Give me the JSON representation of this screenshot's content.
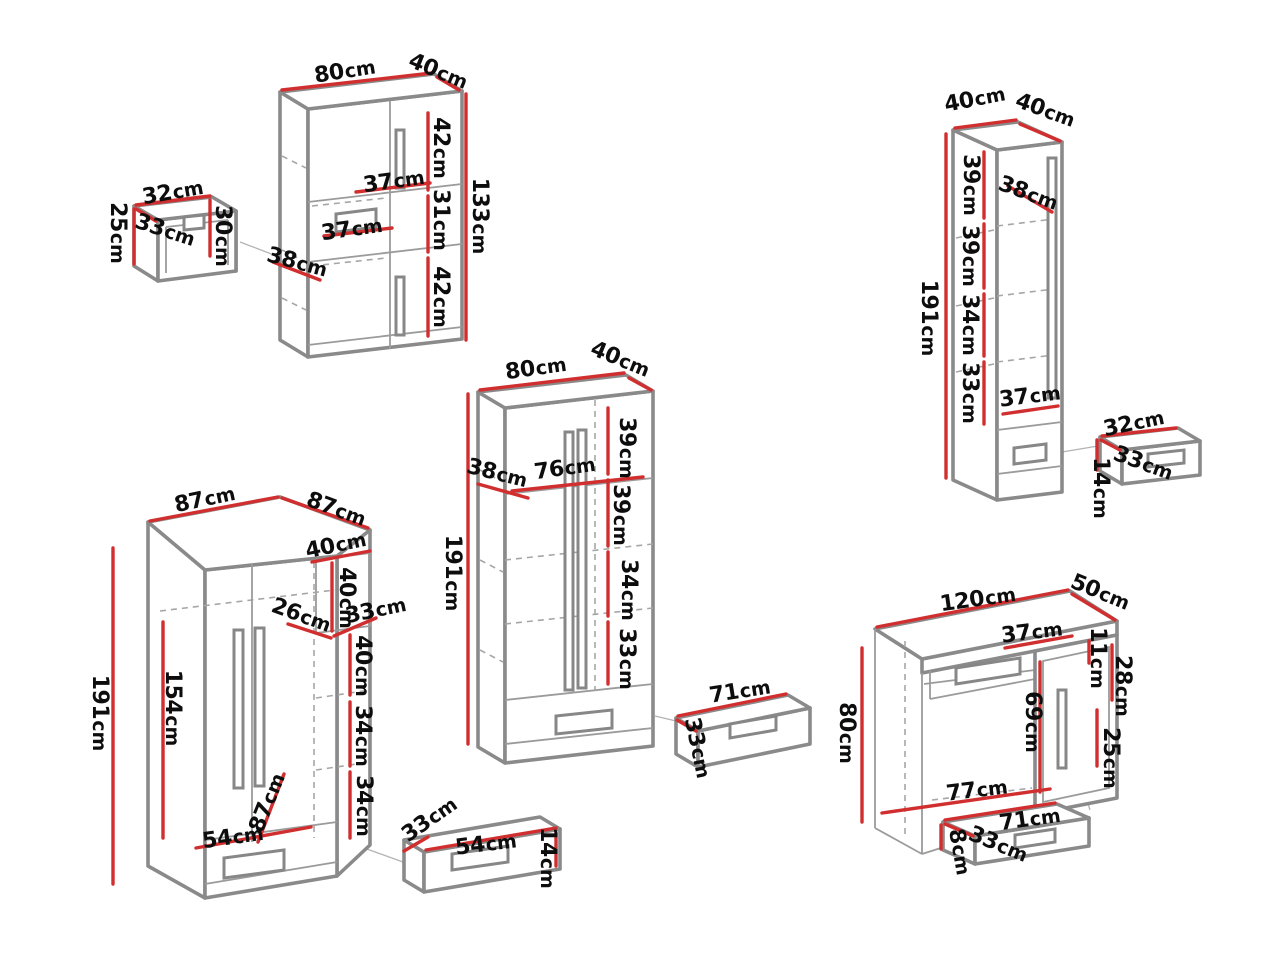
{
  "title": "Furniture set dimension diagram",
  "unit": "cm",
  "colors": {
    "background": "#ffffff",
    "dimension_line": "#d12f2f",
    "furniture_edge": "#8a8a8a",
    "furniture_edge_thin": "#9b9b9b",
    "label_text": "#0d0d0d"
  },
  "pieces": [
    {
      "id": "small-open-box",
      "dimensions": [
        "32cm",
        "33cm",
        "25cm",
        "30cm"
      ]
    },
    {
      "id": "two-door-cabinet-133",
      "dimensions": [
        "80cm",
        "40cm",
        "42cm",
        "37cm",
        "31cm",
        "37cm",
        "38cm",
        "42cm",
        "133cm"
      ]
    },
    {
      "id": "tall-cabinet-191",
      "dimensions": [
        "40cm",
        "40cm",
        "38cm",
        "39cm",
        "39cm",
        "34cm",
        "33cm",
        "37cm",
        "191cm"
      ]
    },
    {
      "id": "small-drawer-box",
      "dimensions": [
        "32cm",
        "33cm",
        "14cm"
      ]
    },
    {
      "id": "two-door-wardrobe-191",
      "dimensions": [
        "80cm",
        "40cm",
        "39cm",
        "38cm",
        "76cm",
        "39cm",
        "34cm",
        "33cm",
        "191cm"
      ]
    },
    {
      "id": "wide-drawer",
      "dimensions": [
        "71cm",
        "33cm"
      ]
    },
    {
      "id": "corner-wardrobe",
      "dimensions": [
        "87cm",
        "87cm",
        "40cm",
        "40cm",
        "26cm",
        "33cm",
        "40cm",
        "34cm",
        "34cm",
        "154cm",
        "191cm",
        "87cm",
        "54cm"
      ]
    },
    {
      "id": "low-drawer",
      "dimensions": [
        "33cm",
        "54cm",
        "14cm"
      ]
    },
    {
      "id": "desk",
      "dimensions": [
        "120cm",
        "50cm",
        "37cm",
        "11cm",
        "28cm",
        "69cm",
        "25cm",
        "80cm",
        "77cm"
      ]
    },
    {
      "id": "desk-drawer",
      "dimensions": [
        "71cm",
        "33cm",
        "8cm"
      ]
    }
  ],
  "dimension_labels": [
    {
      "piece": "small-open-box",
      "text": "32",
      "x": 173,
      "y": 193,
      "rot": -10
    },
    {
      "piece": "small-open-box",
      "text": "33",
      "x": 165,
      "y": 231,
      "rot": 18
    },
    {
      "piece": "small-open-box",
      "text": "25",
      "x": 117,
      "y": 233,
      "rot": 90
    },
    {
      "piece": "small-open-box",
      "text": "30",
      "x": 222,
      "y": 236,
      "rot": 90
    },
    {
      "piece": "two-door-cabinet-133",
      "text": "80",
      "x": 345,
      "y": 72,
      "rot": -9
    },
    {
      "piece": "two-door-cabinet-133",
      "text": "40",
      "x": 438,
      "y": 72,
      "rot": 22
    },
    {
      "piece": "two-door-cabinet-133",
      "text": "42",
      "x": 440,
      "y": 148,
      "rot": 90
    },
    {
      "piece": "two-door-cabinet-133",
      "text": "37",
      "x": 394,
      "y": 182,
      "rot": -8
    },
    {
      "piece": "two-door-cabinet-133",
      "text": "31",
      "x": 440,
      "y": 220,
      "rot": 90
    },
    {
      "piece": "two-door-cabinet-133",
      "text": "37",
      "x": 352,
      "y": 230,
      "rot": -8
    },
    {
      "piece": "two-door-cabinet-133",
      "text": "38",
      "x": 297,
      "y": 263,
      "rot": 15
    },
    {
      "piece": "two-door-cabinet-133",
      "text": "42",
      "x": 440,
      "y": 297,
      "rot": 90
    },
    {
      "piece": "two-door-cabinet-133",
      "text": "133",
      "x": 479,
      "y": 216,
      "rot": 90
    },
    {
      "piece": "tall-cabinet-191",
      "text": "40",
      "x": 975,
      "y": 100,
      "rot": -11
    },
    {
      "piece": "tall-cabinet-191",
      "text": "40",
      "x": 1045,
      "y": 111,
      "rot": 20
    },
    {
      "piece": "tall-cabinet-191",
      "text": "38",
      "x": 1028,
      "y": 194,
      "rot": 20
    },
    {
      "piece": "tall-cabinet-191",
      "text": "39",
      "x": 970,
      "y": 185,
      "rot": 90
    },
    {
      "piece": "tall-cabinet-191",
      "text": "39",
      "x": 969,
      "y": 256,
      "rot": 90
    },
    {
      "piece": "tall-cabinet-191",
      "text": "34",
      "x": 969,
      "y": 325,
      "rot": 90
    },
    {
      "piece": "tall-cabinet-191",
      "text": "33",
      "x": 969,
      "y": 393,
      "rot": 90
    },
    {
      "piece": "tall-cabinet-191",
      "text": "37",
      "x": 1030,
      "y": 397,
      "rot": -7
    },
    {
      "piece": "tall-cabinet-191",
      "text": "191",
      "x": 928,
      "y": 318,
      "rot": 90
    },
    {
      "piece": "small-drawer-box",
      "text": "32",
      "x": 1134,
      "y": 424,
      "rot": -12
    },
    {
      "piece": "small-drawer-box",
      "text": "33",
      "x": 1143,
      "y": 464,
      "rot": 20
    },
    {
      "piece": "small-drawer-box",
      "text": "14",
      "x": 1100,
      "y": 488,
      "rot": 90
    },
    {
      "piece": "two-door-wardrobe-191",
      "text": "80",
      "x": 536,
      "y": 369,
      "rot": -8
    },
    {
      "piece": "two-door-wardrobe-191",
      "text": "40",
      "x": 620,
      "y": 360,
      "rot": 22
    },
    {
      "piece": "two-door-wardrobe-191",
      "text": "39",
      "x": 626,
      "y": 448,
      "rot": 90
    },
    {
      "piece": "two-door-wardrobe-191",
      "text": "38",
      "x": 497,
      "y": 474,
      "rot": 14
    },
    {
      "piece": "two-door-wardrobe-191",
      "text": "76",
      "x": 565,
      "y": 469,
      "rot": -8
    },
    {
      "piece": "two-door-wardrobe-191",
      "text": "39",
      "x": 620,
      "y": 515,
      "rot": 90
    },
    {
      "piece": "two-door-wardrobe-191",
      "text": "34",
      "x": 628,
      "y": 590,
      "rot": 90
    },
    {
      "piece": "two-door-wardrobe-191",
      "text": "33",
      "x": 626,
      "y": 659,
      "rot": 90
    },
    {
      "piece": "two-door-wardrobe-191",
      "text": "191",
      "x": 452,
      "y": 573,
      "rot": 90
    },
    {
      "piece": "wide-drawer",
      "text": "71",
      "x": 740,
      "y": 692,
      "rot": -9
    },
    {
      "piece": "wide-drawer",
      "text": "33",
      "x": 697,
      "y": 748,
      "rot": 78
    },
    {
      "piece": "corner-wardrobe",
      "text": "87",
      "x": 205,
      "y": 500,
      "rot": -12
    },
    {
      "piece": "corner-wardrobe",
      "text": "87",
      "x": 336,
      "y": 510,
      "rot": 20
    },
    {
      "piece": "corner-wardrobe",
      "text": "40",
      "x": 336,
      "y": 546,
      "rot": -12
    },
    {
      "piece": "corner-wardrobe",
      "text": "40",
      "x": 346,
      "y": 598,
      "rot": 90
    },
    {
      "piece": "corner-wardrobe",
      "text": "26",
      "x": 301,
      "y": 616,
      "rot": 20
    },
    {
      "piece": "corner-wardrobe",
      "text": "33",
      "x": 376,
      "y": 611,
      "rot": -12
    },
    {
      "piece": "corner-wardrobe",
      "text": "40",
      "x": 362,
      "y": 666,
      "rot": 90
    },
    {
      "piece": "corner-wardrobe",
      "text": "34",
      "x": 362,
      "y": 736,
      "rot": 90
    },
    {
      "piece": "corner-wardrobe",
      "text": "34",
      "x": 363,
      "y": 806,
      "rot": 90
    },
    {
      "piece": "corner-wardrobe",
      "text": "154",
      "x": 172,
      "y": 708,
      "rot": 90
    },
    {
      "piece": "corner-wardrobe",
      "text": "191",
      "x": 99,
      "y": 713,
      "rot": 90
    },
    {
      "piece": "corner-wardrobe",
      "text": "87",
      "x": 268,
      "y": 803,
      "rot": -68
    },
    {
      "piece": "corner-wardrobe",
      "text": "54",
      "x": 233,
      "y": 838,
      "rot": -8
    },
    {
      "piece": "low-drawer",
      "text": "33",
      "x": 430,
      "y": 820,
      "rot": -35
    },
    {
      "piece": "low-drawer",
      "text": "54",
      "x": 486,
      "y": 845,
      "rot": -7
    },
    {
      "piece": "low-drawer",
      "text": "14",
      "x": 547,
      "y": 858,
      "rot": 90
    },
    {
      "piece": "desk",
      "text": "120",
      "x": 978,
      "y": 600,
      "rot": -8
    },
    {
      "piece": "desk",
      "text": "50",
      "x": 1100,
      "y": 593,
      "rot": 22
    },
    {
      "piece": "desk",
      "text": "37",
      "x": 1032,
      "y": 633,
      "rot": -7
    },
    {
      "piece": "desk",
      "text": "11",
      "x": 1097,
      "y": 658,
      "rot": 90
    },
    {
      "piece": "desk",
      "text": "28",
      "x": 1122,
      "y": 686,
      "rot": 90
    },
    {
      "piece": "desk",
      "text": "69",
      "x": 1032,
      "y": 722,
      "rot": 90
    },
    {
      "piece": "desk",
      "text": "25",
      "x": 1110,
      "y": 758,
      "rot": 90
    },
    {
      "piece": "desk",
      "text": "80",
      "x": 846,
      "y": 733,
      "rot": 90
    },
    {
      "piece": "desk",
      "text": "77",
      "x": 977,
      "y": 791,
      "rot": -7
    },
    {
      "piece": "desk-drawer",
      "text": "71",
      "x": 1030,
      "y": 820,
      "rot": -8
    },
    {
      "piece": "desk-drawer",
      "text": "33",
      "x": 998,
      "y": 845,
      "rot": 22
    },
    {
      "piece": "desk-drawer",
      "text": "8",
      "x": 959,
      "y": 852,
      "rot": 80
    }
  ]
}
